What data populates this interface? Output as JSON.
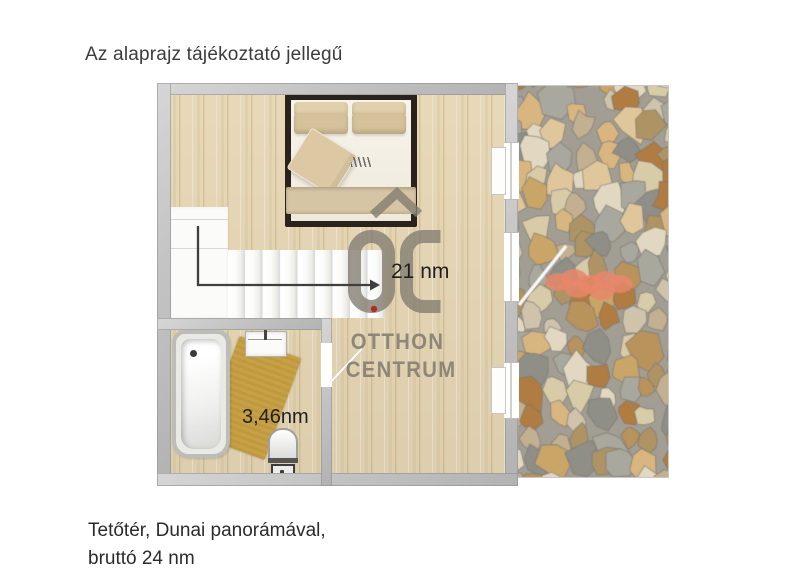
{
  "header": {
    "disclaimer": "Az alaprajz tájékoztató jellegű"
  },
  "footer": {
    "line1": "Tetőtér, Dunai panorámával,",
    "line2": "bruttó 24 nm"
  },
  "plan": {
    "labels": {
      "main_area": "21 nm",
      "bath_area": "3,46nm"
    }
  },
  "watermark": {
    "monogram": "OC",
    "line1": "OTTHON",
    "line2": "CENTRUM"
  },
  "colors": {
    "wall": "#c4c4c4",
    "floor": "#e6d6b4",
    "bed-frame": "#2a231d",
    "bench": "#d5c5a4",
    "rug": "#c9a145",
    "arrow": "#3f3f3f",
    "watermark": "#827b70",
    "watermark-dot": "#b52a20",
    "grout": "#a39e94",
    "chimney": "#e8876a"
  },
  "terrace": {
    "stone_palette": [
      "#d8cba8",
      "#c9a668",
      "#b07c42",
      "#a8a89e",
      "#d9b680",
      "#cfc3ac",
      "#b9935c",
      "#e2d8c2",
      "#ae9464",
      "#c2b090",
      "#8f8f88",
      "#dfc79b"
    ]
  }
}
